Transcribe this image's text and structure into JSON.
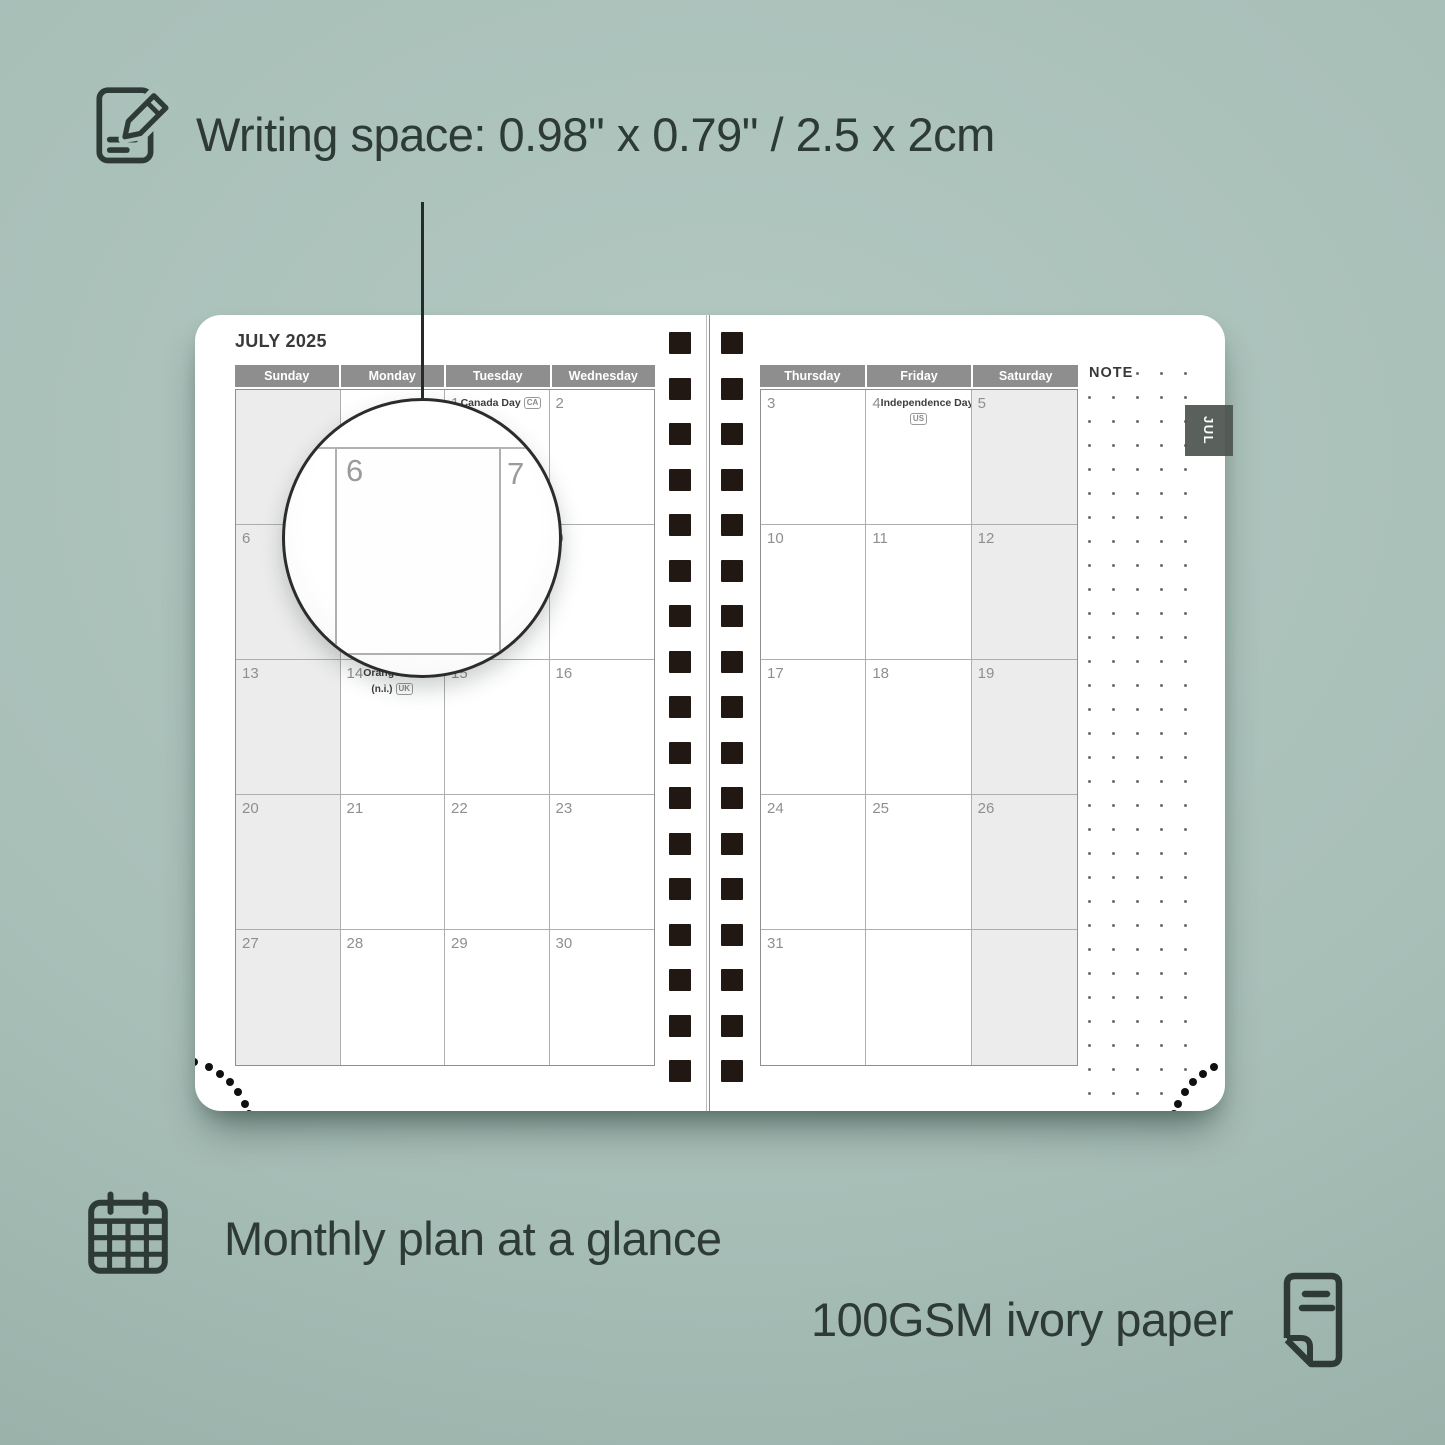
{
  "annotations": {
    "writing_space": "Writing space: 0.98\" x 0.79\" / 2.5 x 2cm",
    "monthly_plan": "Monthly plan at a glance",
    "paper": "100GSM ivory paper"
  },
  "planner": {
    "month_title": "JULY 2025",
    "tab_label": "JUL",
    "note_label": "NOTE",
    "left_page": {
      "headers": [
        "Sunday",
        "Monday",
        "Tuesday",
        "Wednesday"
      ],
      "shaded_column": 0,
      "weeks": [
        [
          {
            "day": ""
          },
          {
            "day": ""
          },
          {
            "day": "1",
            "holiday": {
              "label": "Canada Day",
              "badge": "CA",
              "placement": "inline"
            }
          },
          {
            "day": "2"
          }
        ],
        [
          {
            "day": "6"
          },
          {
            "day": "7"
          },
          {
            "day": "8"
          },
          {
            "day": "9"
          }
        ],
        [
          {
            "day": "13"
          },
          {
            "day": "14",
            "holiday": {
              "label": "Orangemen's Day",
              "sub": "(n.i.)",
              "badge": "UK",
              "placement": "sub"
            }
          },
          {
            "day": "15"
          },
          {
            "day": "16"
          }
        ],
        [
          {
            "day": "20"
          },
          {
            "day": "21"
          },
          {
            "day": "22"
          },
          {
            "day": "23"
          }
        ],
        [
          {
            "day": "27"
          },
          {
            "day": "28"
          },
          {
            "day": "29"
          },
          {
            "day": "30"
          }
        ]
      ]
    },
    "right_page": {
      "headers": [
        "Thursday",
        "Friday",
        "Saturday"
      ],
      "shaded_column": 2,
      "weeks": [
        [
          {
            "day": "3"
          },
          {
            "day": "4",
            "holiday": {
              "label": "Independence Day",
              "badge": "US",
              "placement": "below"
            }
          },
          {
            "day": "5"
          }
        ],
        [
          {
            "day": "10"
          },
          {
            "day": "11"
          },
          {
            "day": "12"
          }
        ],
        [
          {
            "day": "17"
          },
          {
            "day": "18"
          },
          {
            "day": "19"
          }
        ],
        [
          {
            "day": "24"
          },
          {
            "day": "25"
          },
          {
            "day": "26"
          }
        ],
        [
          {
            "day": "31"
          },
          {
            "day": ""
          },
          {
            "day": ""
          }
        ]
      ]
    }
  },
  "magnifier": {
    "left_day": "6",
    "right_day": "7"
  },
  "colors": {
    "background": "#a8bfb8",
    "ink": "#2d3a35",
    "header_gray": "#8e8e8e",
    "shaded_cell": "#ececec",
    "binding_hole": "#221813",
    "tab_gray": "#4e5551"
  }
}
